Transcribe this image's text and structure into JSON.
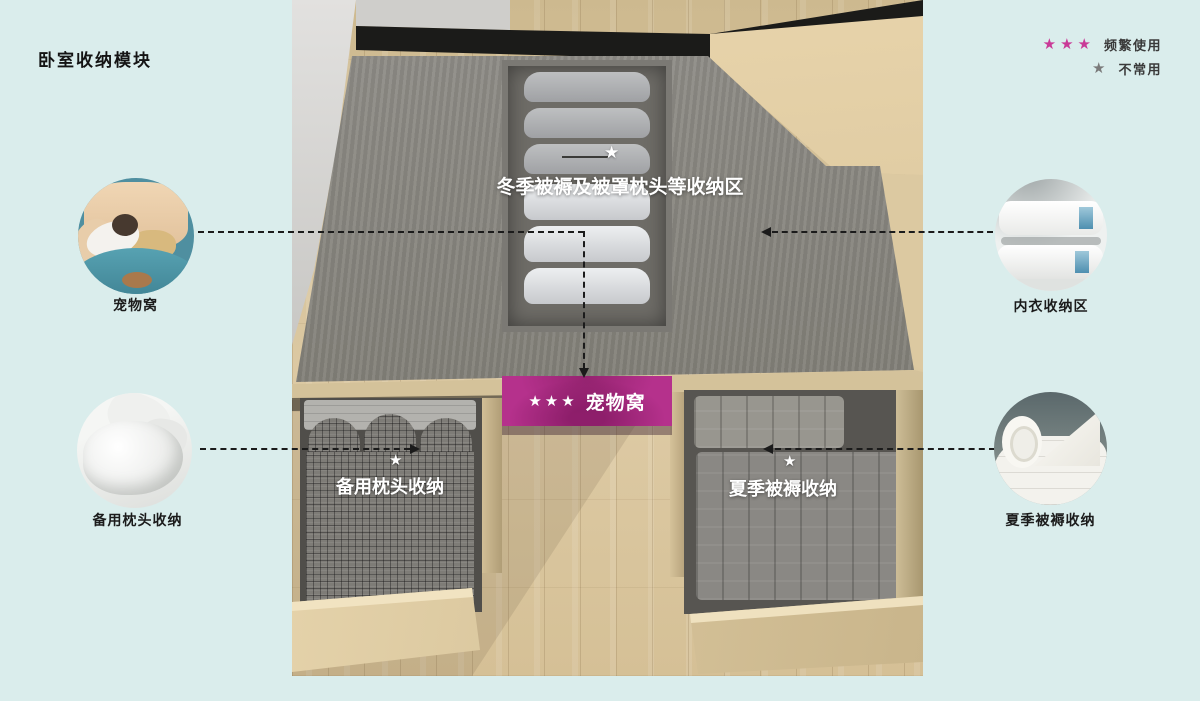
{
  "title": "卧室收纳模块",
  "legend": {
    "frequent": {
      "stars": "★★★",
      "label": "频繁使用"
    },
    "rare": {
      "stars": "★",
      "label": "不常用"
    }
  },
  "colors": {
    "background": "#daedec",
    "accent_magenta": "#c93a97",
    "muted_star": "#7a7a7a",
    "pet_box": "#b5318c"
  },
  "photo_annotations": {
    "winter_area": {
      "star": "★",
      "label": "冬季被褥及被罩枕头等收纳区"
    },
    "pet_box": {
      "stars": "★★★",
      "label": "宠物窝"
    },
    "spare_pillows": {
      "star": "★",
      "label": "备用枕头收纳"
    },
    "summer_bedding": {
      "star": "★",
      "label": "夏季被褥收纳"
    }
  },
  "callouts": {
    "pet_nest": {
      "label": "宠物窝"
    },
    "spare_pillows": {
      "label": "备用枕头收纳"
    },
    "underwear": {
      "label": "内衣收纳区"
    },
    "summer_bedding": {
      "label": "夏季被褥收纳"
    }
  }
}
